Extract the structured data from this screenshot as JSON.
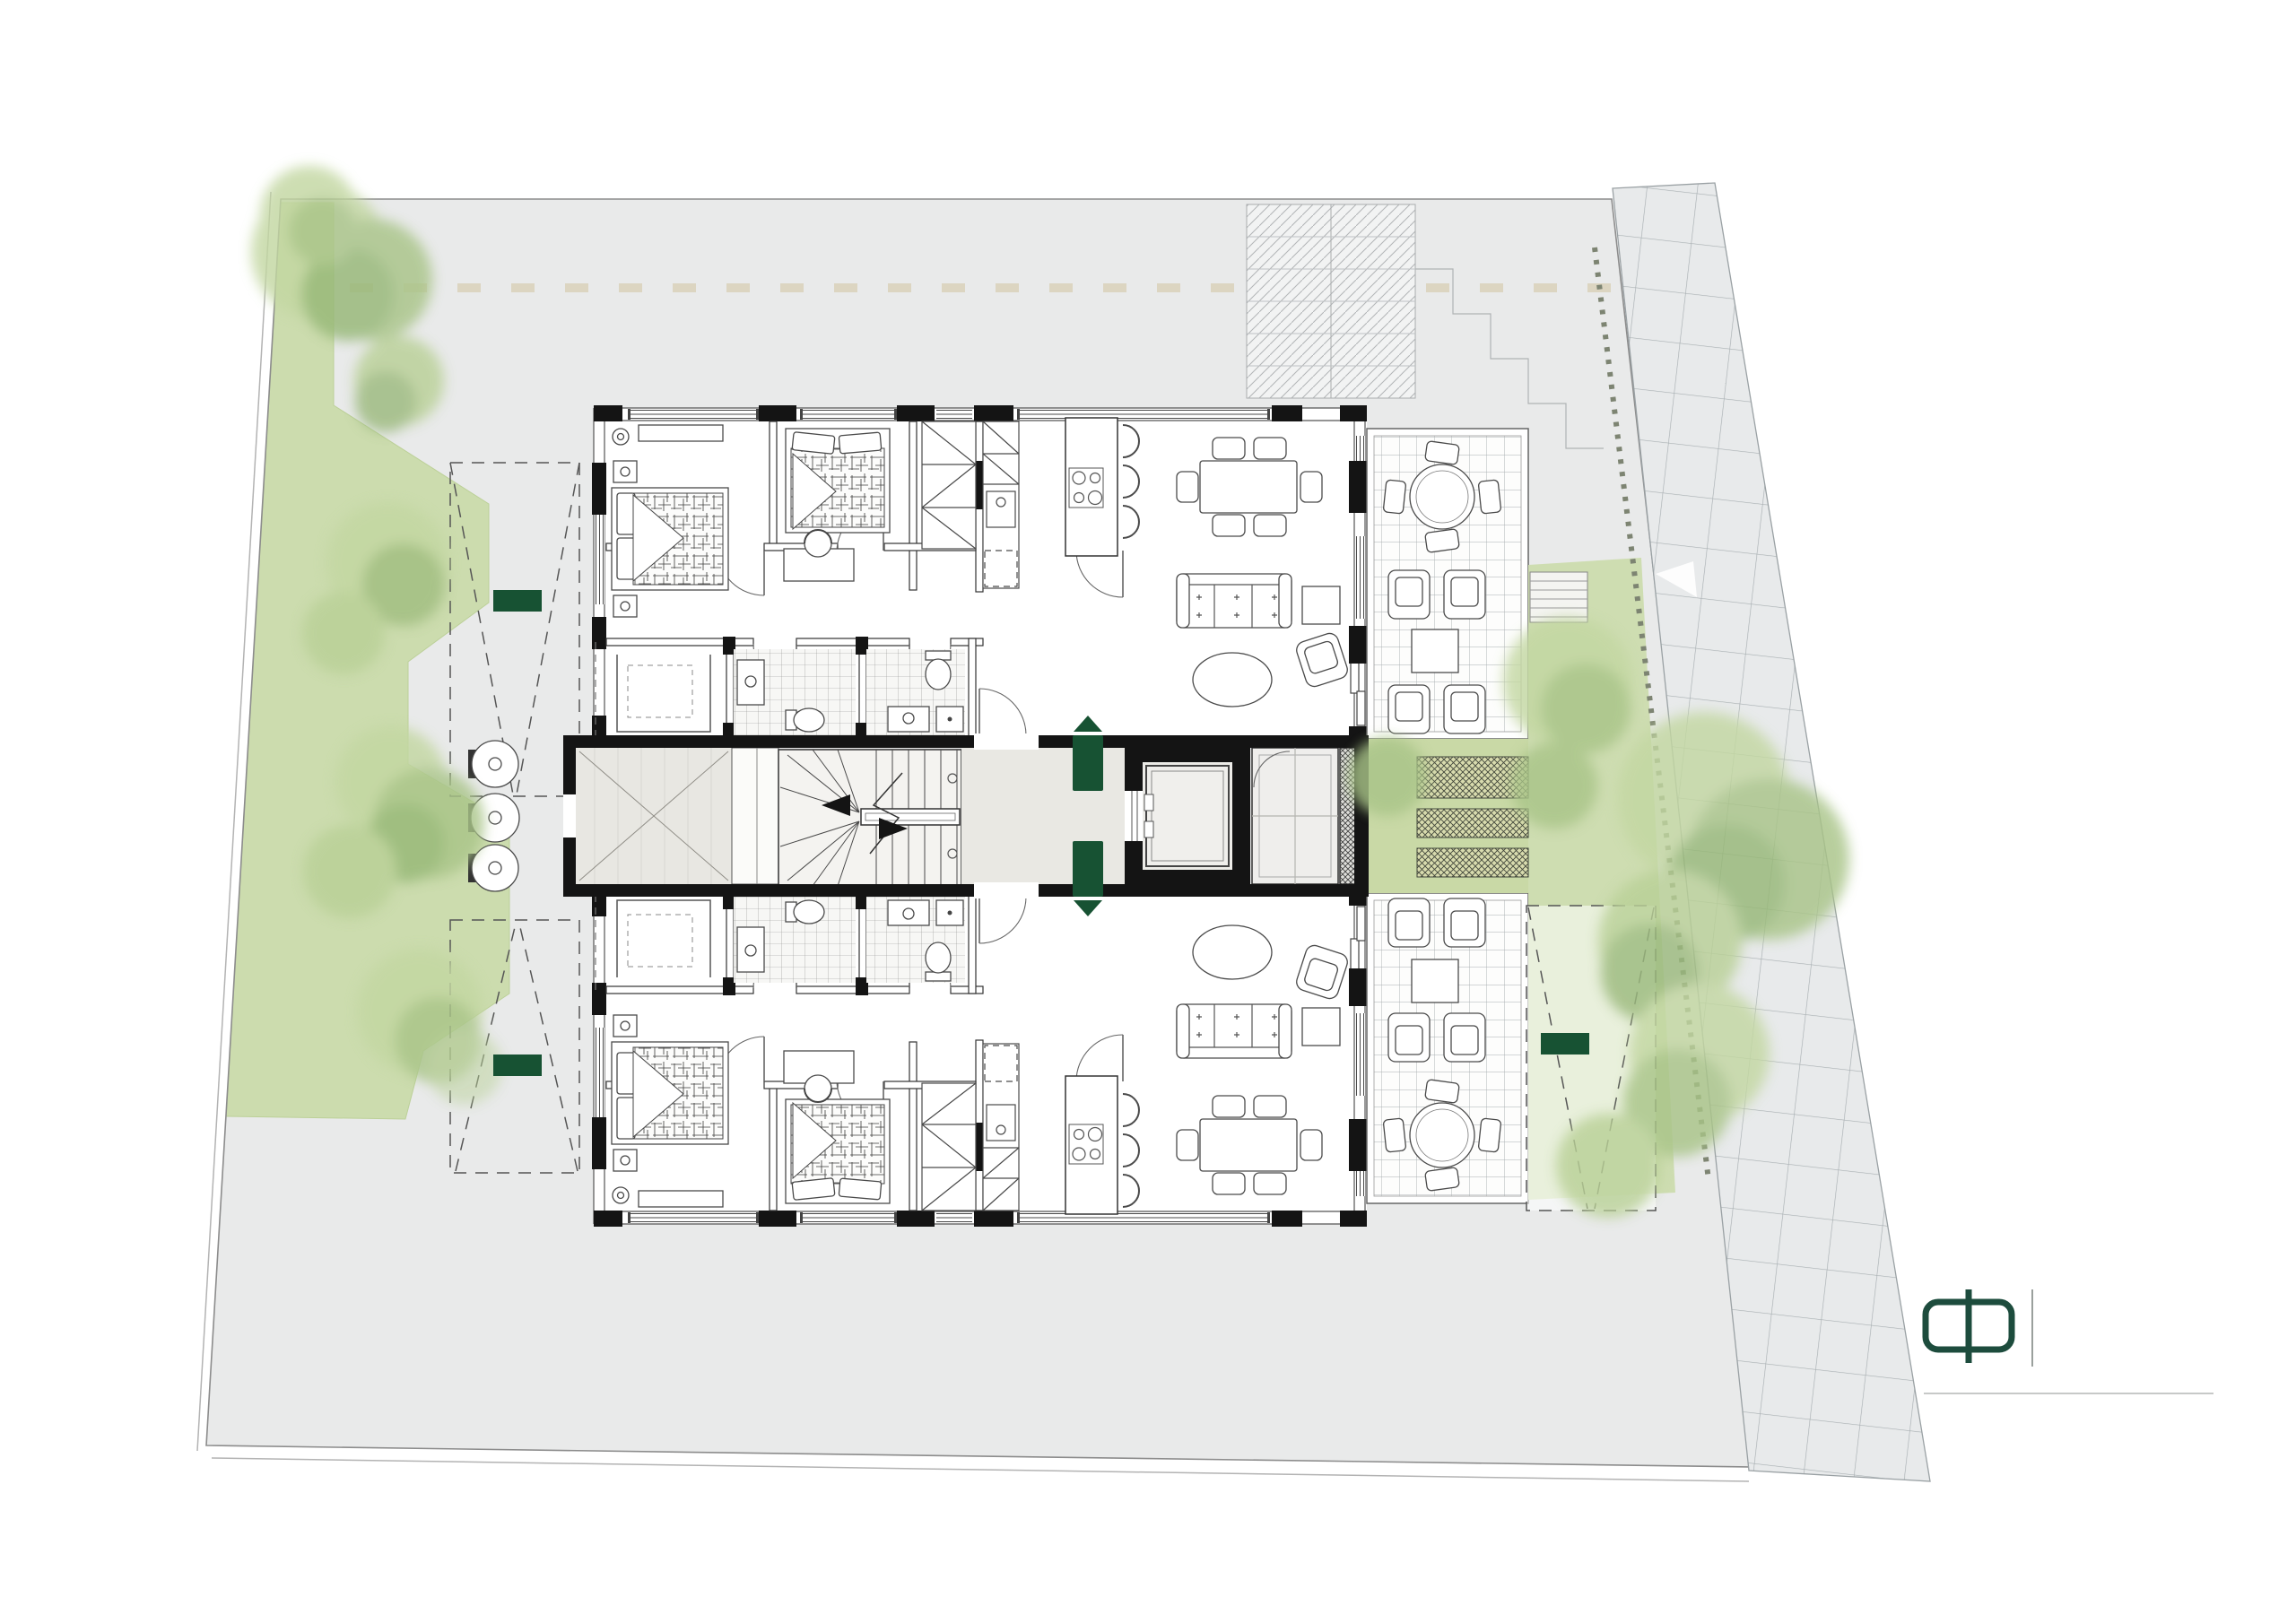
{
  "brand": {
    "name": "Hilltop",
    "tagline": "RESIDENCES",
    "floor_label": {
      "number": "3",
      "ordinal": "rd",
      "word": "Floor"
    }
  },
  "plan": {
    "unit_badges": [
      {
        "id": "302"
      },
      {
        "id": "301"
      }
    ],
    "parking_spaces": [
      {
        "word": "Parking",
        "number": "08",
        "unit": "102"
      },
      {
        "word": "Parking",
        "number": "07",
        "unit": "202"
      },
      {
        "word": "Parking",
        "number": "01",
        "unit": "101"
      }
    ],
    "stair_steps": {
      "up": [
        "01",
        "02",
        "03",
        "04",
        "05",
        "06",
        "07",
        "08"
      ],
      "winders": [
        "09",
        "10"
      ],
      "down": [
        "11",
        "12",
        "13",
        "14",
        "15",
        "16",
        "17",
        "18"
      ]
    }
  },
  "icons": {
    "unit_302_direction": "triangle-up",
    "unit_301_direction": "triangle-down"
  },
  "colors": {
    "brand_green": "#1d4c3d",
    "badge_green": "#175233",
    "site_gray": "#e9eaea",
    "grass_green": "#ccdcae",
    "foliage_green": "#a9c488",
    "paving_gray": "#e8eaeb",
    "wall_black": "#141414",
    "survey_dash_tan": "#d8cfb4"
  }
}
